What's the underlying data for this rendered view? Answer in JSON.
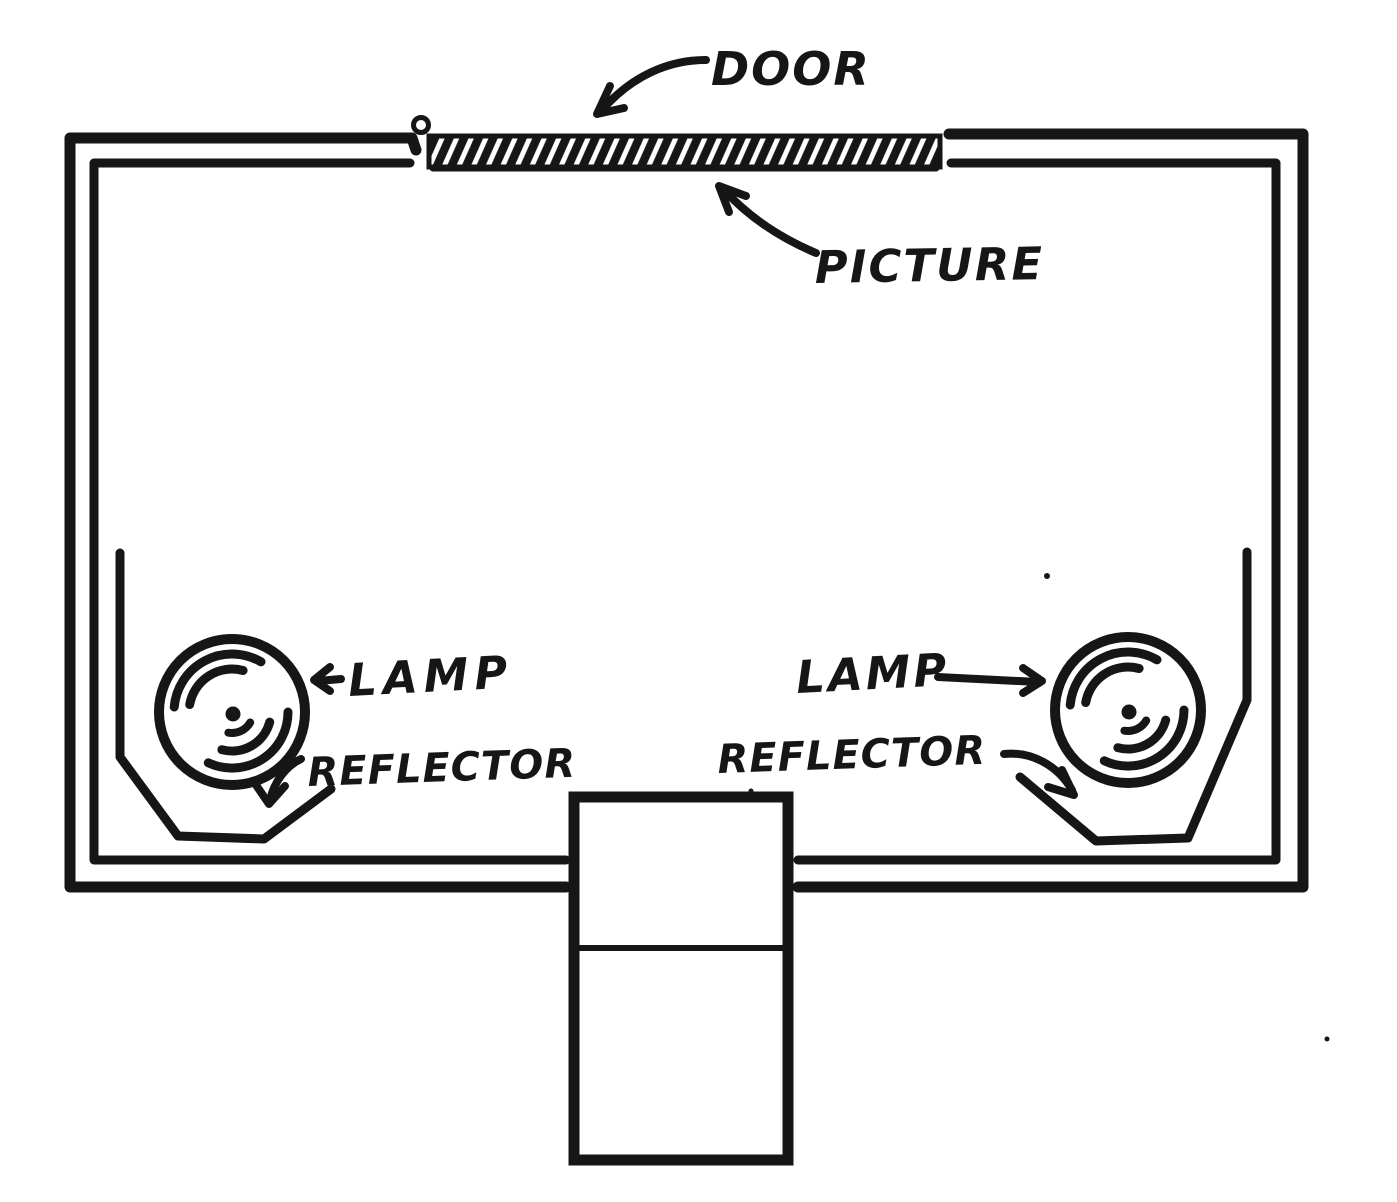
{
  "figure": {
    "labels": {
      "door": "DOOR",
      "picture": "PICTURE",
      "lamp_left": "LAMP",
      "reflector_left": "REFLECTOR",
      "lamp_right": "LAMP",
      "reflector_right": "REFLECTOR"
    },
    "colors": {
      "ink": "#161616",
      "paper": "#ffffff"
    }
  }
}
